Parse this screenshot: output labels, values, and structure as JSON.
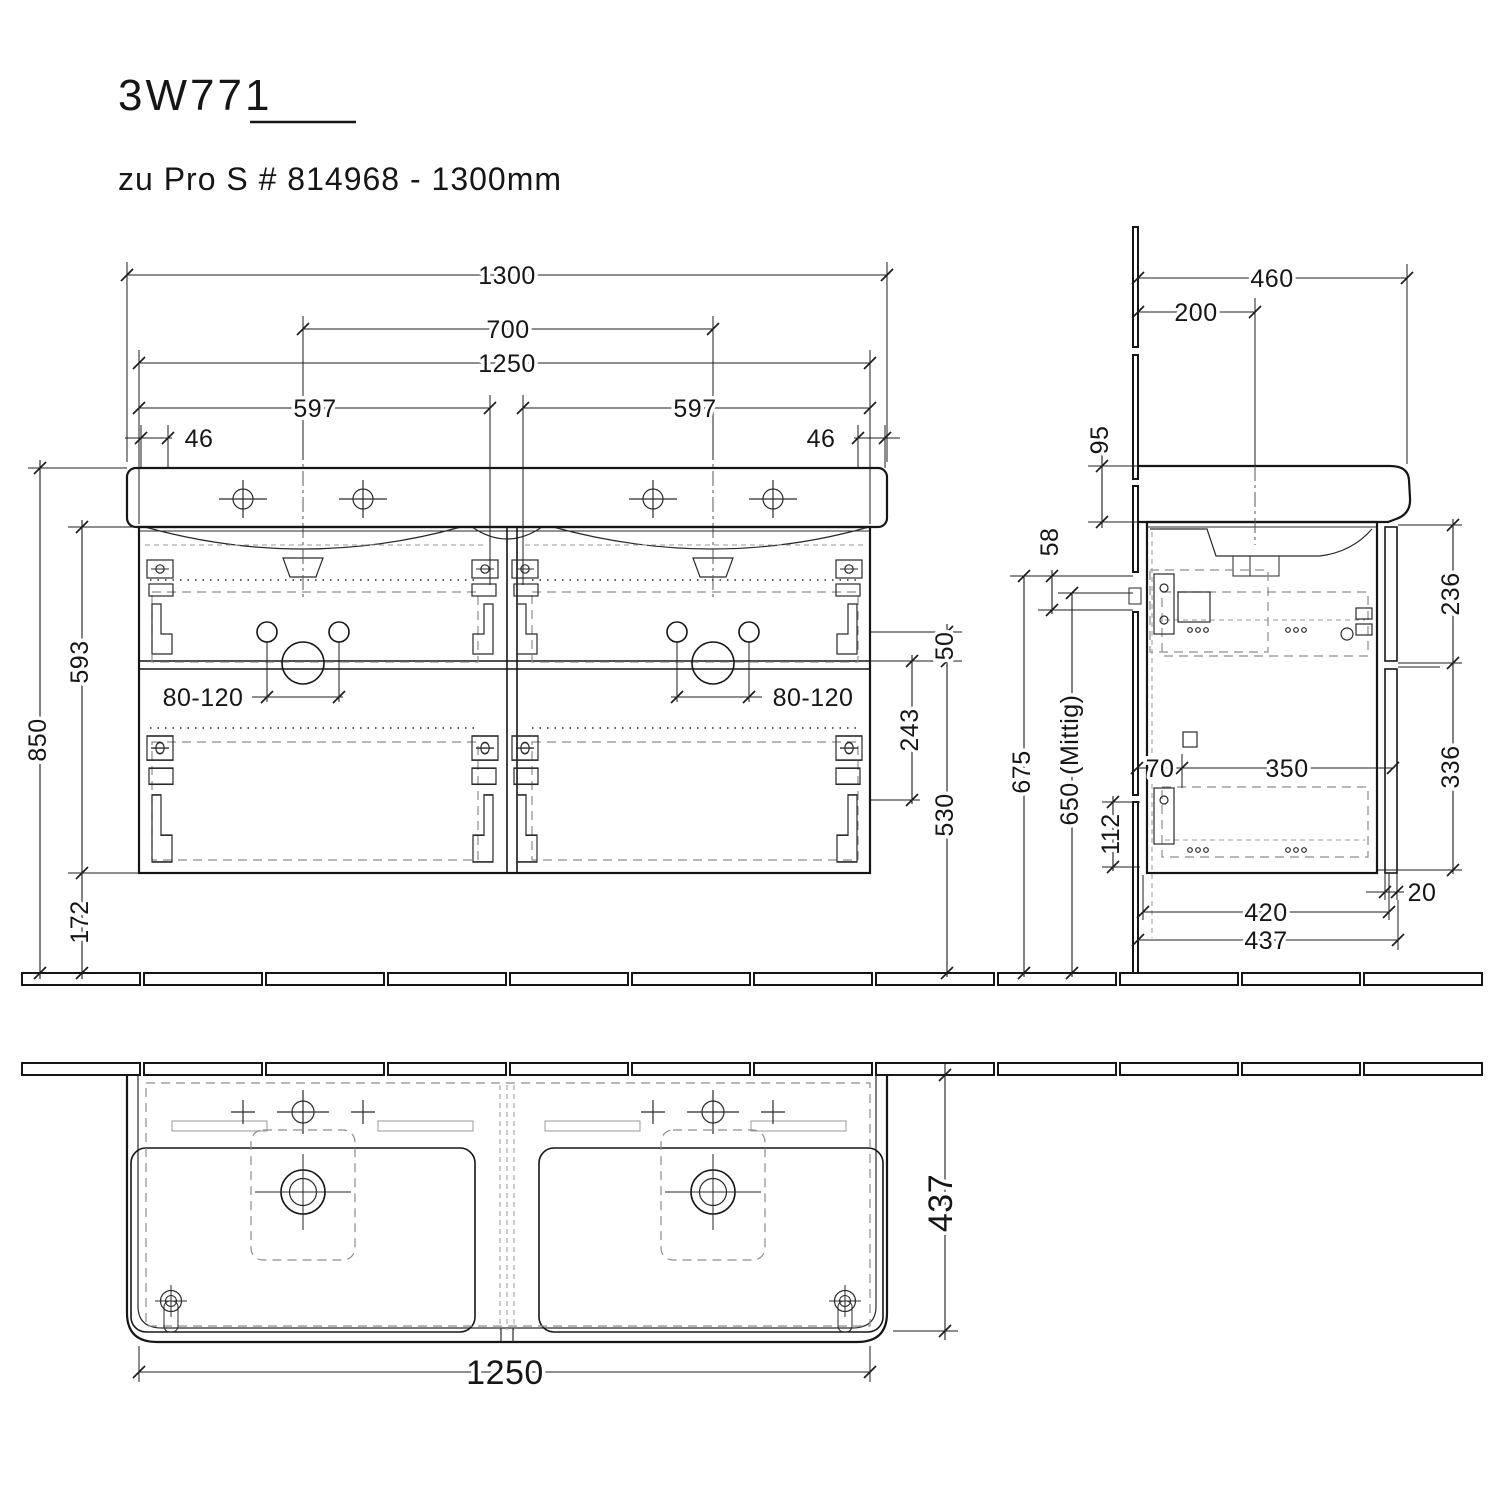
{
  "product": {
    "model": "3W771",
    "description": "zu Pro S # 814968 - 1300mm"
  },
  "views": {
    "front": {
      "total_width": "1300",
      "faucet_hole_distance": "700",
      "cabinet_width": "1250",
      "left_drawer_width": "597",
      "right_drawer_width": "597",
      "left_edge_offset": "46",
      "right_edge_offset": "46",
      "total_height": "850",
      "cabinet_height": "593",
      "bottom_clearance": "172",
      "left_supply_zone": "80-120",
      "right_supply_zone": "80-120",
      "zone_gap": "50",
      "drain_drop": "243",
      "drain_height": "530"
    },
    "connection": {
      "outlet_zone_height": "58",
      "outlet_top_height": "675",
      "outlet_center_height": "650 (Mittig)"
    },
    "side": {
      "total_depth": "460",
      "faucet_wall_distance": "200",
      "basin_front_height": "95",
      "upper_section_height": "236",
      "lower_section_height": "336",
      "rail_wall_offset": "70",
      "rail_length": "350",
      "lower_rail_height": "112",
      "front_panel_thickness": "20",
      "cabinet_depth": "420",
      "overall_depth": "437"
    },
    "plan": {
      "ceramic_width": "1250",
      "ceramic_depth": "437"
    }
  }
}
